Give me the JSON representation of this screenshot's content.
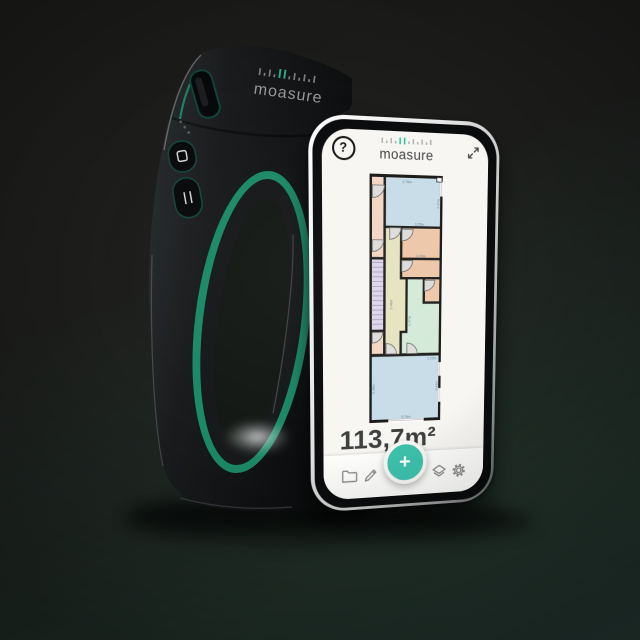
{
  "scene": {
    "background_top": "#1c1c1a",
    "background_bottom": "#243732"
  },
  "device": {
    "brand": "moasure",
    "body_color": "#17191a",
    "accent_color": "#1b8a67"
  },
  "app": {
    "help": "?",
    "brand": "moasure",
    "area": "113,7m²",
    "fab": "+",
    "accent_color": "#3ec3ae",
    "toolbar_icons": [
      "folder",
      "edit",
      "add",
      "layers",
      "settings"
    ]
  },
  "floorplan": {
    "total_area": "113,7m²",
    "room_colors": {
      "blue": "#c9dde9",
      "peach": "#f2d8c3",
      "orange": "#eec8a9",
      "khaki": "#e7e4c1",
      "mint": "#d5ead9",
      "lavender": "#ded7e9"
    },
    "labels": {
      "top_width": "4.79m",
      "top_right": "4.47m",
      "top_bottom": "3.23m",
      "orange_width": "3.23m",
      "hall_height": "3.40m",
      "mint_height": "1.47m",
      "mint_bottom": "1.23m",
      "bottom_width": "5.79m",
      "bottom_left": "5.38m",
      "bottom_right": "4.43m"
    }
  }
}
